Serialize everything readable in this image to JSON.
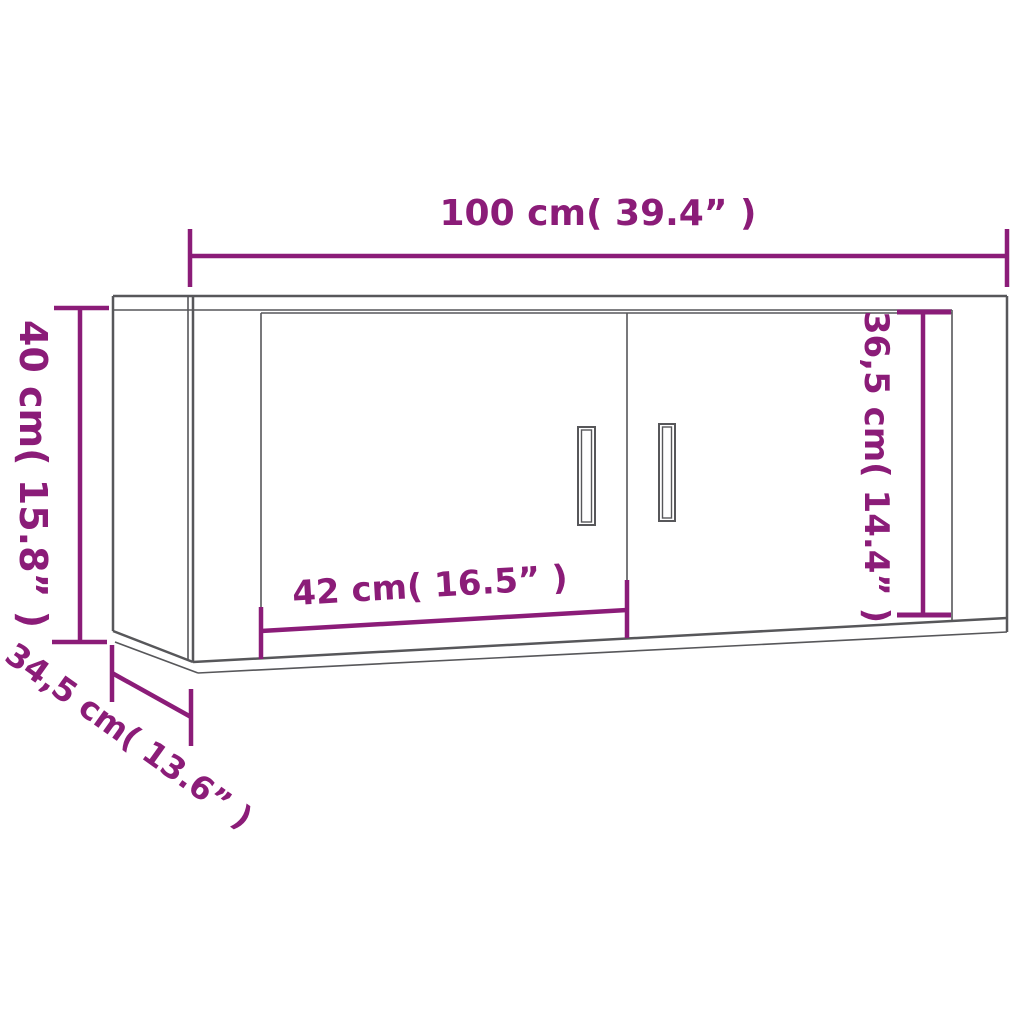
{
  "page": {
    "type": "product dimension diagram",
    "product": "wall-mounted cabinet with two doors",
    "background": "#ffffff"
  },
  "colors": {
    "dimension_accent": "#8b1c78",
    "cabinet_outline": "#57575a"
  },
  "dimensions": {
    "width": "100 cm( 39.4” )",
    "height": "40 cm( 15.8” )",
    "inner_height": "36,5 cm( 14.4” )",
    "door_width": "42 cm( 16.5” )",
    "depth": "34,5 cm( 13.6” )"
  }
}
